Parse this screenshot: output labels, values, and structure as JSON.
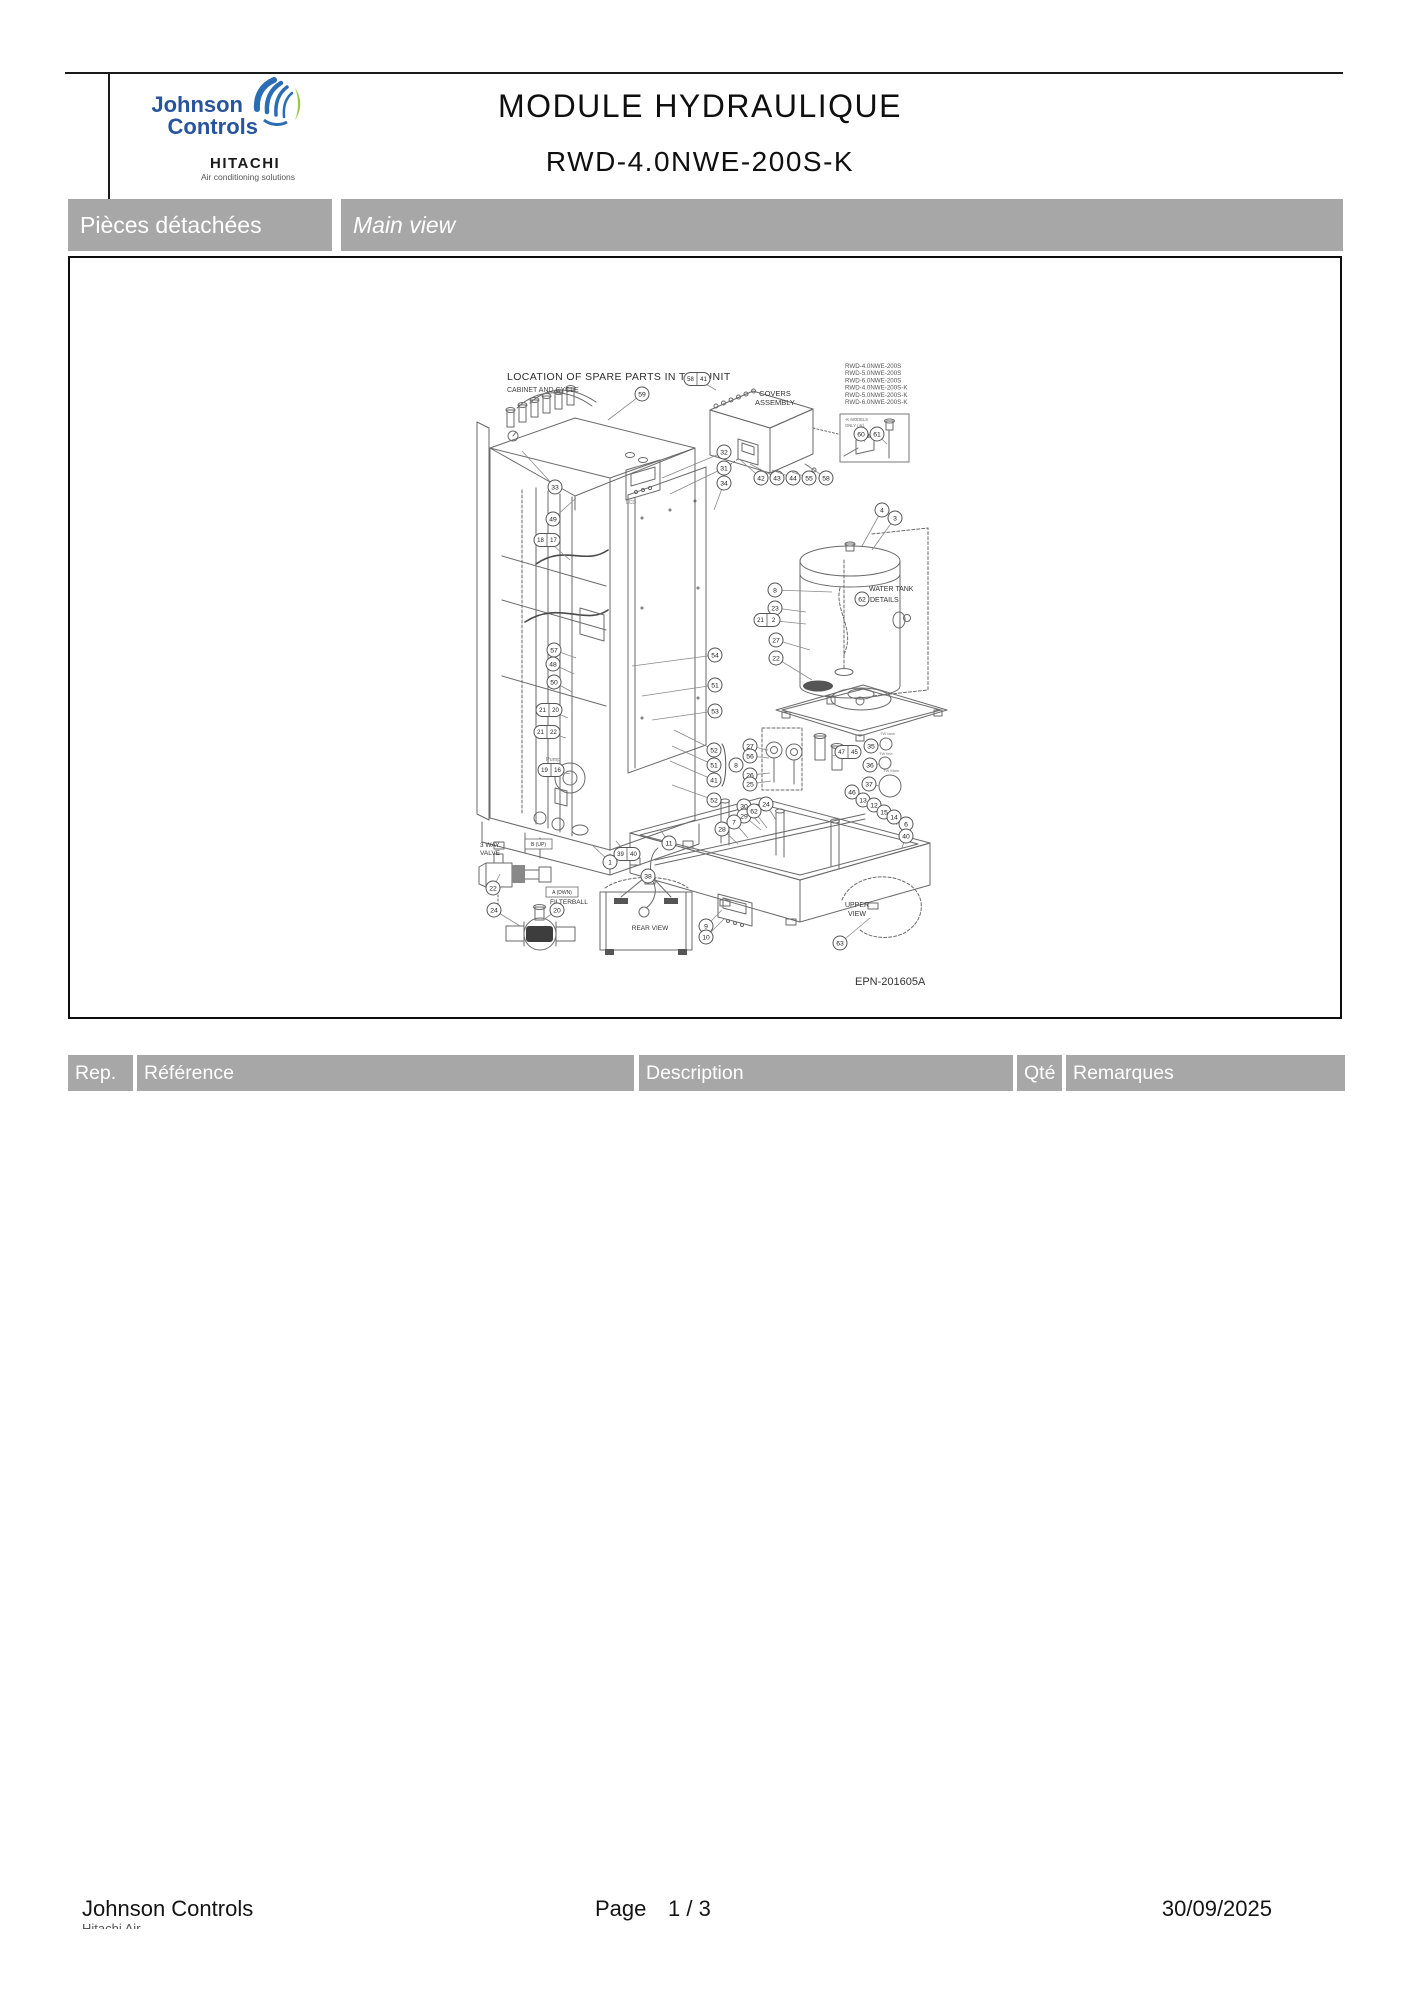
{
  "header": {
    "brand": {
      "line1": "Johnson",
      "line2": "Controls",
      "sub_brand": "HITACHI",
      "sub_brand_tagline": "Air conditioning solutions",
      "brand_color": "#27549d",
      "swirl_blue": "#2a6db5",
      "swirl_green": "#94c83d"
    },
    "title": "MODULE HYDRAULIQUE",
    "subtitle": "RWD-4.0NWE-200S-K"
  },
  "section_bar": {
    "left": "Pièces détachées",
    "right": "Main view"
  },
  "table": {
    "headers": [
      "Rep.",
      "Référence",
      "Description",
      "Qté",
      "Remarques"
    ],
    "rows": []
  },
  "footer": {
    "company": "Johnson Controls",
    "clipped_line": "Hitachi Air conditioning",
    "page_label": "Page",
    "page_number": "1 / 3",
    "date": "30/09/2025"
  },
  "diagram": {
    "drawing_ref": "EPN-201605A",
    "heading": "LOCATION OF SPARE PARTS IN THE UNIT",
    "subheading": "CABINET AND CYCLE",
    "models": [
      "RWD-4.0NWE-200S",
      "RWD-5.0NWE-200S",
      "RWD-6.0NWE-200S",
      "RWD-4.0NWE-200S-K",
      "RWD-5.0NWE-200S-K",
      "RWD-6.0NWE-200S-K"
    ],
    "texts": [
      {
        "t": "COVERS",
        "x": 705,
        "y": 138,
        "s": 7.5,
        "a": "middle"
      },
      {
        "t": "ASSEMBLY",
        "x": 705,
        "y": 147,
        "s": 7.5,
        "a": "middle"
      },
      {
        "t": "WATER TANK",
        "x": 799,
        "y": 333,
        "s": 7
      },
      {
        "t": "DETAILS",
        "x": 800,
        "y": 344,
        "s": 7
      },
      {
        "t": "UPPER",
        "x": 787,
        "y": 649,
        "s": 7,
        "a": "middle"
      },
      {
        "t": "VIEW",
        "x": 787,
        "y": 658,
        "s": 7,
        "a": "middle"
      },
      {
        "t": "REAR VIEW",
        "x": 580,
        "y": 672,
        "s": 6.5,
        "a": "middle"
      },
      {
        "t": "FILTERBALL",
        "x": 480,
        "y": 646,
        "s": 6.5
      },
      {
        "t": "3 WAY",
        "x": 410,
        "y": 589,
        "s": 6.5
      },
      {
        "t": "VALVE",
        "x": 410,
        "y": 597,
        "s": 6.5
      },
      {
        "t": "Pump",
        "x": 476,
        "y": 503,
        "s": 5.5,
        "c": "#777"
      },
      {
        "t": "LCD",
        "x": 556,
        "y": 246,
        "s": 5,
        "c": "#777"
      },
      {
        "t": "-K MODELS",
        "x": 775,
        "y": 163,
        "s": 4.2,
        "c": "#666"
      },
      {
        "t": "ONLY (-K)",
        "x": 775,
        "y": 169,
        "s": 4.2,
        "c": "#666"
      },
      {
        "t": "TW tank",
        "x": 810,
        "y": 477,
        "s": 4,
        "c": "#777"
      },
      {
        "t": "TW line",
        "x": 809,
        "y": 497,
        "s": 4,
        "c": "#777"
      },
      {
        "t": "TW Main",
        "x": 813,
        "y": 514,
        "s": 4,
        "c": "#777"
      }
    ],
    "boxed_labels": [
      {
        "t": "B (UP)",
        "x": 455,
        "y": 581,
        "w": 27,
        "h": 10
      },
      {
        "t": "A (DWN)",
        "x": 476,
        "y": 629,
        "w": 32,
        "h": 10
      }
    ],
    "callouts": [
      {
        "n": "59",
        "x": 572,
        "y": 136,
        "l": [
          538,
          162
        ]
      },
      {
        "n": "33",
        "x": 485,
        "y": 229,
        "l": [
          452,
          193
        ]
      },
      {
        "n": "49",
        "x": 483,
        "y": 261,
        "l": [
          506,
          240
        ]
      },
      {
        "n": "18|17",
        "x": 477,
        "y": 282,
        "l": [
          500,
          302
        ]
      },
      {
        "n": "57",
        "x": 484,
        "y": 392,
        "l": [
          506,
          400
        ]
      },
      {
        "n": "48",
        "x": 483,
        "y": 406,
        "l": [
          504,
          416
        ]
      },
      {
        "n": "50",
        "x": 484,
        "y": 424,
        "l": [
          502,
          434
        ]
      },
      {
        "n": "21|20",
        "x": 479,
        "y": 452,
        "l": [
          498,
          460
        ]
      },
      {
        "n": "21|22",
        "x": 477,
        "y": 474,
        "l": [
          496,
          480
        ]
      },
      {
        "n": "19|16",
        "x": 481,
        "y": 512,
        "l": [
          500,
          516
        ]
      },
      {
        "n": "32",
        "x": 654,
        "y": 194,
        "l": [
          592,
          220
        ]
      },
      {
        "n": "31",
        "x": 654,
        "y": 210,
        "l": [
          600,
          236
        ]
      },
      {
        "n": "34",
        "x": 654,
        "y": 225,
        "l": [
          644,
          252
        ]
      },
      {
        "n": "54",
        "x": 645,
        "y": 397,
        "l": [
          562,
          408
        ]
      },
      {
        "n": "51",
        "x": 645,
        "y": 427,
        "l": [
          572,
          438
        ]
      },
      {
        "n": "53",
        "x": 645,
        "y": 453,
        "l": [
          582,
          462
        ]
      },
      {
        "n": "52",
        "x": 644,
        "y": 492,
        "l": [
          604,
          472
        ]
      },
      {
        "n": "51",
        "x": 644,
        "y": 507,
        "l": [
          602,
          488
        ]
      },
      {
        "n": "41",
        "x": 644,
        "y": 522,
        "l": [
          600,
          503
        ]
      },
      {
        "n": "8",
        "x": 666,
        "y": 507
      },
      {
        "n": "52",
        "x": 644,
        "y": 542,
        "l": [
          602,
          527
        ]
      },
      {
        "n": "1",
        "x": 540,
        "y": 604,
        "l": [
          522,
          587
        ]
      },
      {
        "n": "39|40",
        "x": 557,
        "y": 596,
        "l": [
          546,
          583
        ]
      },
      {
        "n": "11",
        "x": 599,
        "y": 585,
        "l": [
          590,
          571
        ]
      },
      {
        "n": "58|41",
        "x": 627,
        "y": 121,
        "l": [
          646,
          132
        ]
      },
      {
        "n": "42",
        "x": 691,
        "y": 220,
        "l": [
          668,
          200
        ]
      },
      {
        "n": "43",
        "x": 707,
        "y": 220,
        "l": [
          680,
          206
        ]
      },
      {
        "n": "44",
        "x": 723,
        "y": 220,
        "l": [
          702,
          212
        ]
      },
      {
        "n": "55",
        "x": 739,
        "y": 220,
        "l": [
          722,
          214
        ]
      },
      {
        "n": "58",
        "x": 756,
        "y": 220,
        "l": [
          738,
          208
        ]
      },
      {
        "n": "60",
        "x": 791,
        "y": 176,
        "l": [
          795,
          184
        ]
      },
      {
        "n": "61",
        "x": 807,
        "y": 176,
        "l": [
          817,
          186
        ]
      },
      {
        "n": "8",
        "x": 705,
        "y": 332,
        "l": [
          762,
          334
        ]
      },
      {
        "n": "23",
        "x": 705,
        "y": 350,
        "l": [
          736,
          354
        ]
      },
      {
        "n": "21|2",
        "x": 697,
        "y": 362,
        "l": [
          736,
          366
        ]
      },
      {
        "n": "27",
        "x": 706,
        "y": 382,
        "l": [
          740,
          392
        ]
      },
      {
        "n": "22",
        "x": 706,
        "y": 400,
        "l": [
          742,
          422
        ]
      },
      {
        "n": "4",
        "x": 812,
        "y": 252,
        "l": [
          792,
          288
        ]
      },
      {
        "n": "3",
        "x": 825,
        "y": 260,
        "l": [
          802,
          292
        ]
      },
      {
        "n": "62",
        "x": 792,
        "y": 341
      },
      {
        "n": "27",
        "x": 680,
        "y": 488,
        "l": [
          698,
          492
        ]
      },
      {
        "n": "56",
        "x": 680,
        "y": 498,
        "l": [
          699,
          500
        ]
      },
      {
        "n": "26",
        "x": 680,
        "y": 517,
        "l": [
          700,
          515
        ]
      },
      {
        "n": "25",
        "x": 680,
        "y": 526,
        "l": [
          701,
          523
        ]
      },
      {
        "n": "47|45",
        "x": 778,
        "y": 494,
        "l": [
          762,
          498
        ]
      },
      {
        "n": "35",
        "x": 801,
        "y": 488,
        "l": [
          810,
          487
        ]
      },
      {
        "n": "36",
        "x": 800,
        "y": 507,
        "l": [
          809,
          506
        ]
      },
      {
        "n": "37",
        "x": 799,
        "y": 526,
        "l": [
          809,
          528
        ]
      },
      {
        "n": "46",
        "x": 782,
        "y": 534,
        "l": [
          792,
          546
        ]
      },
      {
        "n": "13",
        "x": 793,
        "y": 542,
        "l": [
          801,
          552
        ]
      },
      {
        "n": "12",
        "x": 804,
        "y": 547,
        "l": [
          810,
          557
        ]
      },
      {
        "n": "15",
        "x": 814,
        "y": 554,
        "l": [
          819,
          563
        ]
      },
      {
        "n": "14",
        "x": 824,
        "y": 559,
        "l": [
          827,
          567
        ]
      },
      {
        "n": "6",
        "x": 836,
        "y": 566,
        "l": [
          838,
          576
        ]
      },
      {
        "n": "40",
        "x": 836,
        "y": 578,
        "l": [
          832,
          590
        ]
      },
      {
        "n": "30",
        "x": 674,
        "y": 548,
        "l": [
          690,
          566
        ]
      },
      {
        "n": "29",
        "x": 674,
        "y": 558,
        "l": [
          691,
          572
        ]
      },
      {
        "n": "62",
        "x": 684,
        "y": 553,
        "l": [
          697,
          570
        ]
      },
      {
        "n": "24",
        "x": 696,
        "y": 546,
        "l": [
          706,
          562
        ]
      },
      {
        "n": "28",
        "x": 652,
        "y": 571,
        "l": [
          668,
          586
        ]
      },
      {
        "n": "7",
        "x": 664,
        "y": 564,
        "l": [
          678,
          580
        ]
      },
      {
        "n": "9",
        "x": 636,
        "y": 668,
        "l": [
          652,
          652
        ]
      },
      {
        "n": "10",
        "x": 636,
        "y": 679,
        "l": [
          655,
          660
        ]
      },
      {
        "n": "63",
        "x": 770,
        "y": 685,
        "l": [
          800,
          660
        ]
      },
      {
        "n": "38",
        "x": 578,
        "y": 618
      },
      {
        "n": "22",
        "x": 423,
        "y": 630,
        "l": [
          430,
          616
        ]
      },
      {
        "n": "24",
        "x": 424,
        "y": 652,
        "l": [
          450,
          668
        ]
      },
      {
        "n": "20",
        "x": 487,
        "y": 652,
        "l": [
          473,
          662
        ]
      }
    ]
  }
}
